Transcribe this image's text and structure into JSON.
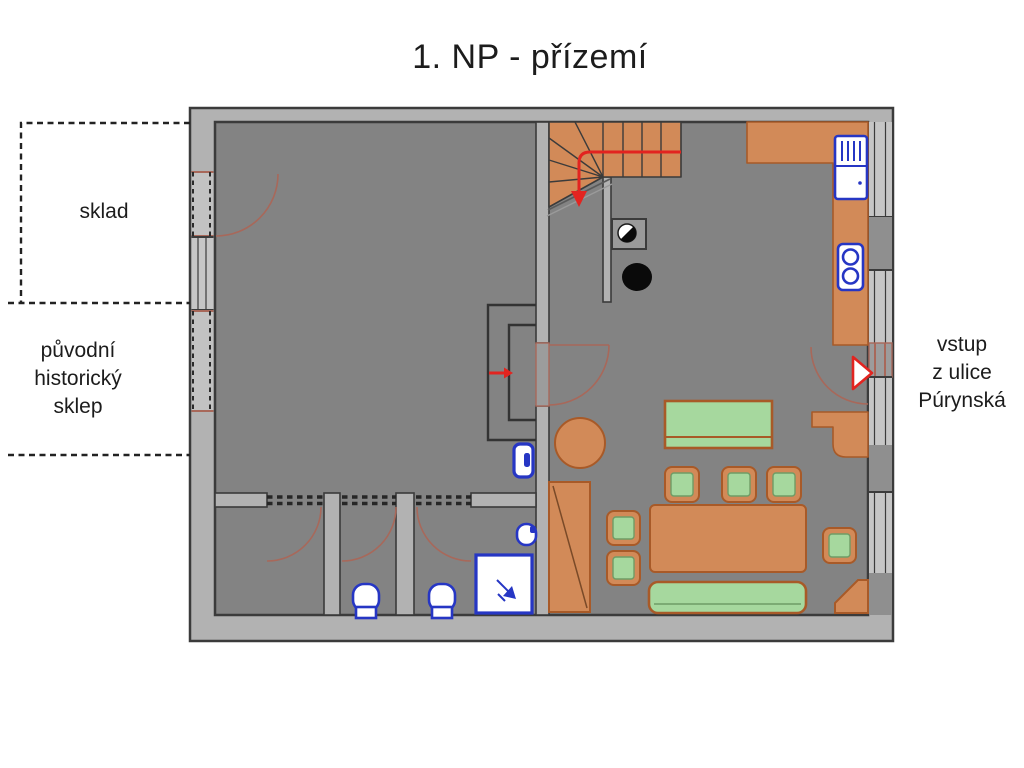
{
  "title": "1. NP - přízemí",
  "labels": {
    "storage": "sklad",
    "cellar_lines": [
      "původní",
      "historický",
      "sklep"
    ],
    "entrance_lines": [
      "vstup",
      "z ulice",
      "Púrynská"
    ]
  },
  "fixtures": [
    "staircase",
    "stair-direction-arrow",
    "chimney",
    "column-symbol",
    "kitchen-counter",
    "refrigerator",
    "stove",
    "entry-door",
    "entry-arrow",
    "entry-cabinet",
    "round-table",
    "wardrobe",
    "sofa",
    "armchair",
    "dining-table",
    "dining-chair",
    "bench",
    "corner-cabinet",
    "toilet",
    "shower",
    "washbasin",
    "door-swing",
    "passage-steps",
    "passage-arrow"
  ],
  "colors": {
    "floor": "#838383",
    "wall": "#b2b2b2",
    "wall_dark": "#8f8f8f",
    "window": "#c6c6c6",
    "outline": "#3b3b3b",
    "orange": "#d28a58",
    "orange_dark": "#a85a28",
    "green": "#a6d89e",
    "green_dark": "#6f9c66",
    "blue": "#2636c4",
    "red": "#e22420",
    "arc": "#a8685a",
    "dash": "#222222",
    "text": "#1c1c1c"
  }
}
